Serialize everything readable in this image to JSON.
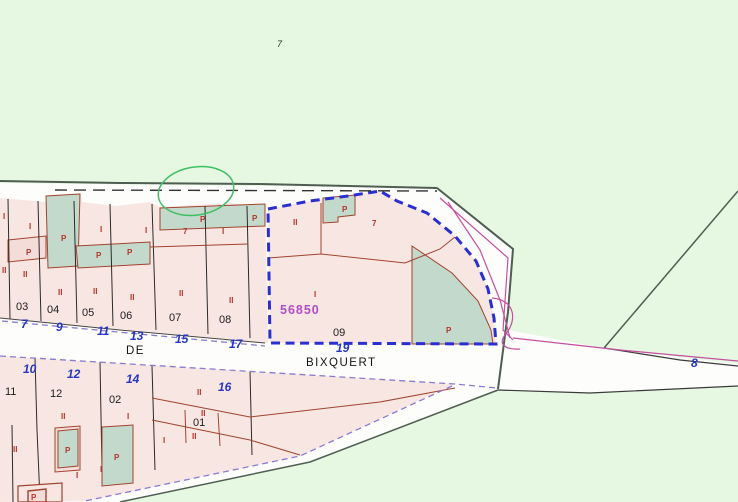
{
  "map": {
    "area_number": "7",
    "street": {
      "prefix": "DE",
      "name": "BIXQUERT"
    },
    "selected_parcel": {
      "code": "56850",
      "block_label": "09"
    },
    "colors": {
      "background_green": "#e6f8e1",
      "urban_white": "#fdfdfc",
      "parcel_pink": "#f8e6e3",
      "parcel_teal": "#c3d9cb",
      "selection_blue": "#2b2fd0",
      "boundary_dark": "#4f5d52",
      "subdivision_red": "#a0442f",
      "road_violet": "#8a7bd0",
      "inner_magenta": "#c5509f",
      "label_red": "#b5342a",
      "number_blue": "#2636c2",
      "code_magenta": "#b14fc0",
      "annotation_green": "#3fbf63"
    },
    "street_numbers": [
      {
        "text": "7",
        "x": 21,
        "y": 328
      },
      {
        "text": "9",
        "x": 56,
        "y": 331
      },
      {
        "text": "11",
        "x": 97,
        "y": 335
      },
      {
        "text": "13",
        "x": 130,
        "y": 340
      },
      {
        "text": "15",
        "x": 175,
        "y": 343
      },
      {
        "text": "17",
        "x": 229,
        "y": 348
      },
      {
        "text": "19",
        "x": 336,
        "y": 352
      },
      {
        "text": "10",
        "x": 23,
        "y": 373
      },
      {
        "text": "12",
        "x": 67,
        "y": 378
      },
      {
        "text": "14",
        "x": 126,
        "y": 383
      },
      {
        "text": "16",
        "x": 218,
        "y": 391
      },
      {
        "text": "8",
        "x": 691,
        "y": 367
      }
    ],
    "parcel_ids": [
      {
        "text": "03",
        "x": 16,
        "y": 310
      },
      {
        "text": "04",
        "x": 47,
        "y": 313
      },
      {
        "text": "05",
        "x": 82,
        "y": 316
      },
      {
        "text": "06",
        "x": 120,
        "y": 319
      },
      {
        "text": "07",
        "x": 169,
        "y": 321
      },
      {
        "text": "08",
        "x": 219,
        "y": 323
      },
      {
        "text": "11",
        "x": 5,
        "y": 395
      },
      {
        "text": "12",
        "x": 50,
        "y": 397
      },
      {
        "text": "02",
        "x": 109,
        "y": 403
      },
      {
        "text": "01",
        "x": 193,
        "y": 426
      }
    ],
    "use_labels": [
      {
        "text": "I",
        "x": 3,
        "y": 219
      },
      {
        "text": "II",
        "x": 2,
        "y": 273
      },
      {
        "text": "I",
        "x": 29,
        "y": 229
      },
      {
        "text": "P",
        "x": 26,
        "y": 255
      },
      {
        "text": "II",
        "x": 23,
        "y": 277
      },
      {
        "text": "P",
        "x": 61,
        "y": 241
      },
      {
        "text": "II",
        "x": 58,
        "y": 295
      },
      {
        "text": "I",
        "x": 100,
        "y": 232
      },
      {
        "text": "P",
        "x": 96,
        "y": 258
      },
      {
        "text": "II",
        "x": 93,
        "y": 294
      },
      {
        "text": "I",
        "x": 145,
        "y": 233
      },
      {
        "text": "P",
        "x": 127,
        "y": 255
      },
      {
        "text": "II",
        "x": 130,
        "y": 300
      },
      {
        "text": "P",
        "x": 200,
        "y": 222
      },
      {
        "text": "P",
        "x": 252,
        "y": 221
      },
      {
        "text": "7",
        "x": 183,
        "y": 234
      },
      {
        "text": "II",
        "x": 179,
        "y": 296
      },
      {
        "text": "I",
        "x": 222,
        "y": 234
      },
      {
        "text": "II",
        "x": 229,
        "y": 303
      },
      {
        "text": "II",
        "x": 293,
        "y": 225
      },
      {
        "text": "P",
        "x": 342,
        "y": 212
      },
      {
        "text": "7",
        "x": 372,
        "y": 226
      },
      {
        "text": "I",
        "x": 314,
        "y": 297
      },
      {
        "text": "P",
        "x": 446,
        "y": 333
      },
      {
        "text": "II",
        "x": 13,
        "y": 452
      },
      {
        "text": "II",
        "x": 61,
        "y": 419
      },
      {
        "text": "I",
        "x": 127,
        "y": 419
      },
      {
        "text": "II",
        "x": 197,
        "y": 395
      },
      {
        "text": "II",
        "x": 201,
        "y": 416
      },
      {
        "text": "I",
        "x": 163,
        "y": 443
      },
      {
        "text": "II",
        "x": 192,
        "y": 439
      },
      {
        "text": "P",
        "x": 65,
        "y": 453
      },
      {
        "text": "P",
        "x": 114,
        "y": 460
      },
      {
        "text": "I",
        "x": 76,
        "y": 478
      },
      {
        "text": "I",
        "x": 100,
        "y": 472
      },
      {
        "text": "P",
        "x": 31,
        "y": 500
      }
    ]
  }
}
